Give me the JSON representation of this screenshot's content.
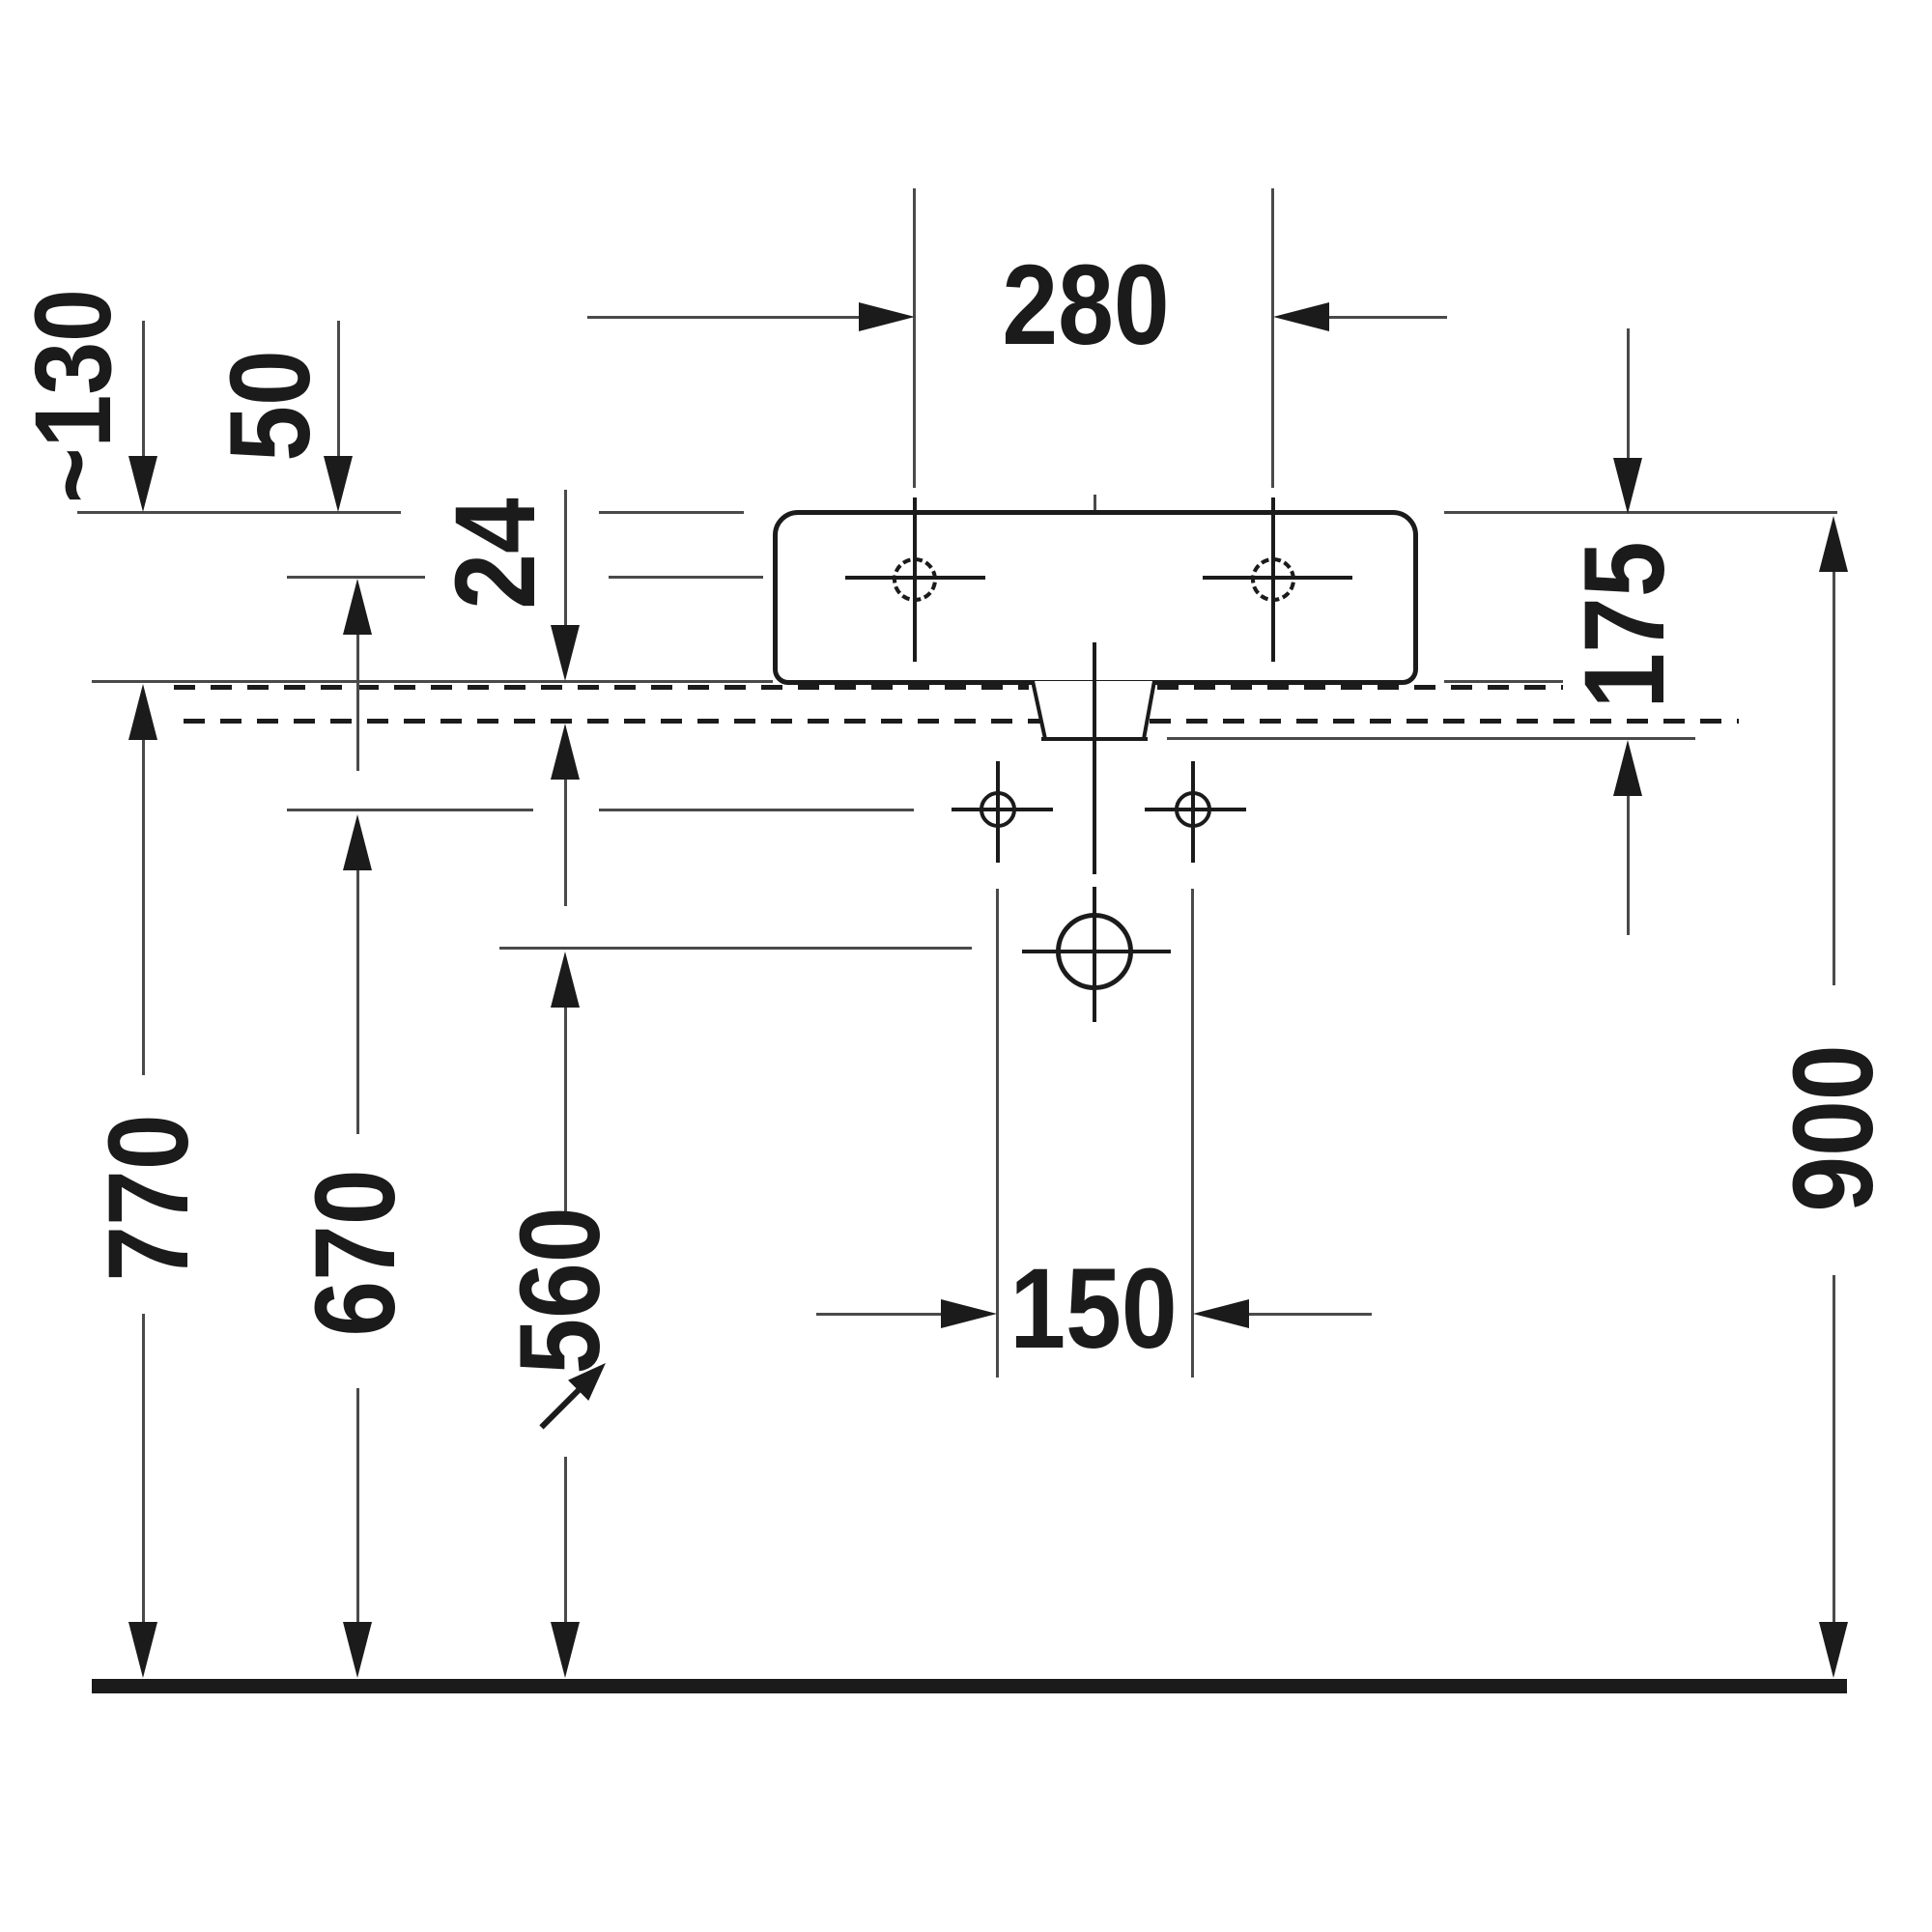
{
  "title": "Wall-mounted washbasin installation drawing, front elevation",
  "units": "mm",
  "labels": {
    "approx130": "~130",
    "d50": "50",
    "d24": "24",
    "d280": "280",
    "d175": "175",
    "d770": "770",
    "d670": "670",
    "d560": "560",
    "d150": "150",
    "d900": "900"
  },
  "dimensions_mm": [
    {
      "name": "tap-hole spacing",
      "value": "280"
    },
    {
      "name": "rim to tap-hole centre",
      "value": "50"
    },
    {
      "name": "rim to mounting surface (approx.)",
      "value": "~130"
    },
    {
      "name": "mounting surface offset gap",
      "value": "24"
    },
    {
      "name": "rim to bottom of drain tailpiece",
      "value": "175"
    },
    {
      "name": "floor to mounting surface",
      "value": "770"
    },
    {
      "name": "floor to fixing holes",
      "value": "670"
    },
    {
      "name": "floor to drain centre",
      "value": "560"
    },
    {
      "name": "fixing-hole spacing",
      "value": "150"
    },
    {
      "name": "floor to rim top",
      "value": "900"
    }
  ]
}
